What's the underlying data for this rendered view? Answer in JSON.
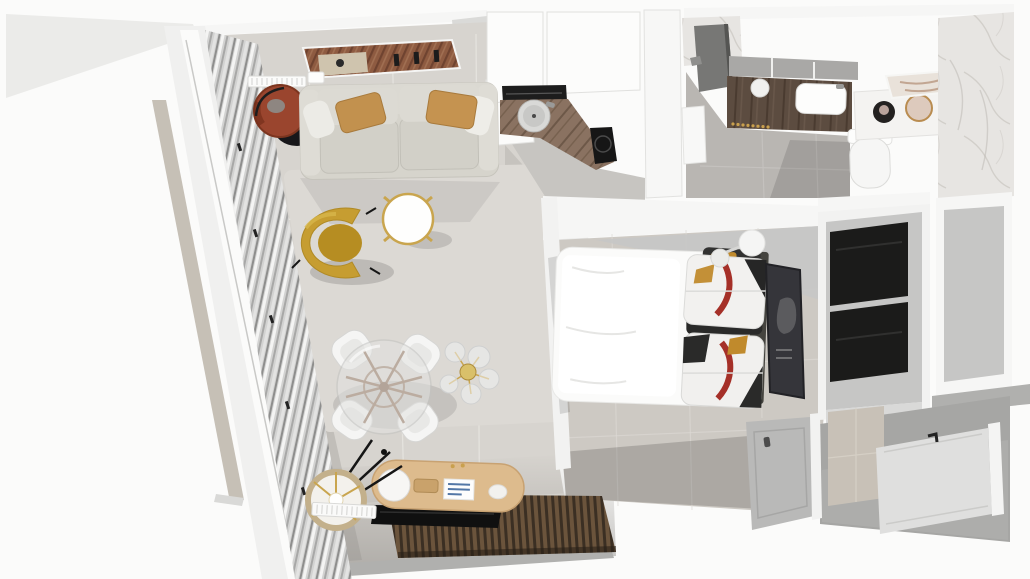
{
  "scene": {
    "type": "3d-floorplan-top-down-render",
    "view": "tilted overhead perspective, walls cut white",
    "rooms": [
      {
        "name": "living-room",
        "items": [
          "panoramic-wood-artwork",
          "wall-radiator",
          "terracotta-lounge-chair",
          "fabric-sofa",
          "amber-lumbar-pillows",
          "area-rug",
          "mustard-wingback-armchair",
          "round-gold-rim-coffee-table",
          "glass-dining-table-wood-base",
          "white-shell-dining-chairs",
          "glass-globe-pendant-light",
          "oval-wood-sideboard",
          "sphere-table-lamp",
          "wood-tray",
          "magazine",
          "decor-shell",
          "wall-mounted-tv",
          "wood-slat-accent-panel",
          "drum-shade-floor-lamp",
          "baseboard-radiator",
          "sheer-curtains",
          "window-wall"
        ]
      },
      {
        "name": "kitchen",
        "items": [
          "white-upper-cabinets",
          "white-base-cabinet",
          "black-vent-shelf",
          "wood-countertop",
          "round-sink",
          "faucet",
          "induction-cooktop",
          "partition-wall"
        ]
      },
      {
        "name": "bathroom",
        "items": [
          "marble-counter",
          "dark-shower-panel",
          "mirror-shelf-band",
          "dark-wood-vanity",
          "white-basin",
          "round-dish",
          "gold-towel-rail",
          "wall-hung-toilet",
          "shelf-black-candle",
          "gold-rim-tray",
          "leaning-mirror",
          "marble-wall"
        ]
      },
      {
        "name": "bedroom",
        "items": [
          "double-bed-white-duvet",
          "graphic-print-pillows",
          "dark-headboard",
          "double-globe-wall-lamp",
          "leaning-dark-artwork",
          "interior-door"
        ]
      },
      {
        "name": "hallway",
        "items": [
          "dark-panel-wardrobe",
          "gray-wall-panel",
          "tiled-wall-section",
          "entry-door",
          "door-handle"
        ]
      }
    ]
  },
  "palette": {
    "bg": "#fbfbfa",
    "wallWhite": "#f6f6f5",
    "wallShade": "#ebebe9",
    "wallGray": "#c6c6c5",
    "wallDark": "#b0b0ae",
    "floorLiving": "#d7d4cf",
    "floorKitchen": "#c7c5c1",
    "floorBath": "#b9b6b2",
    "floorBed": "#cdc9c3",
    "floorHall": "#a6a6a4",
    "rug": "#dcd9d4",
    "curtain": "#d2d2d1",
    "sofa": "#d6d4cc",
    "pillowAmber": "#c2914e",
    "chairTerracotta": "#9a452e",
    "chairMustard": "#c69d31",
    "gold": "#c9a54e",
    "counterWood": "#8a7261",
    "vanityWood": "#5c4c40",
    "sideboardWood": "#ddbb8d",
    "slat": "#6b543c",
    "slatDark": "#3b2f23",
    "tv": "#101010",
    "marble": "#e7e5e2",
    "bed": "#fbfbfa",
    "pillowInk": "#2a2a29",
    "pillowRed": "#a53028",
    "pillowYellow": "#c08a2c",
    "artFrame": "#35353a",
    "wardrobe": "#1b1b1a",
    "doorGray": "#b9b9b8",
    "entryDoor": "#dfdfde",
    "tileWall": "#c8c1b7"
  }
}
